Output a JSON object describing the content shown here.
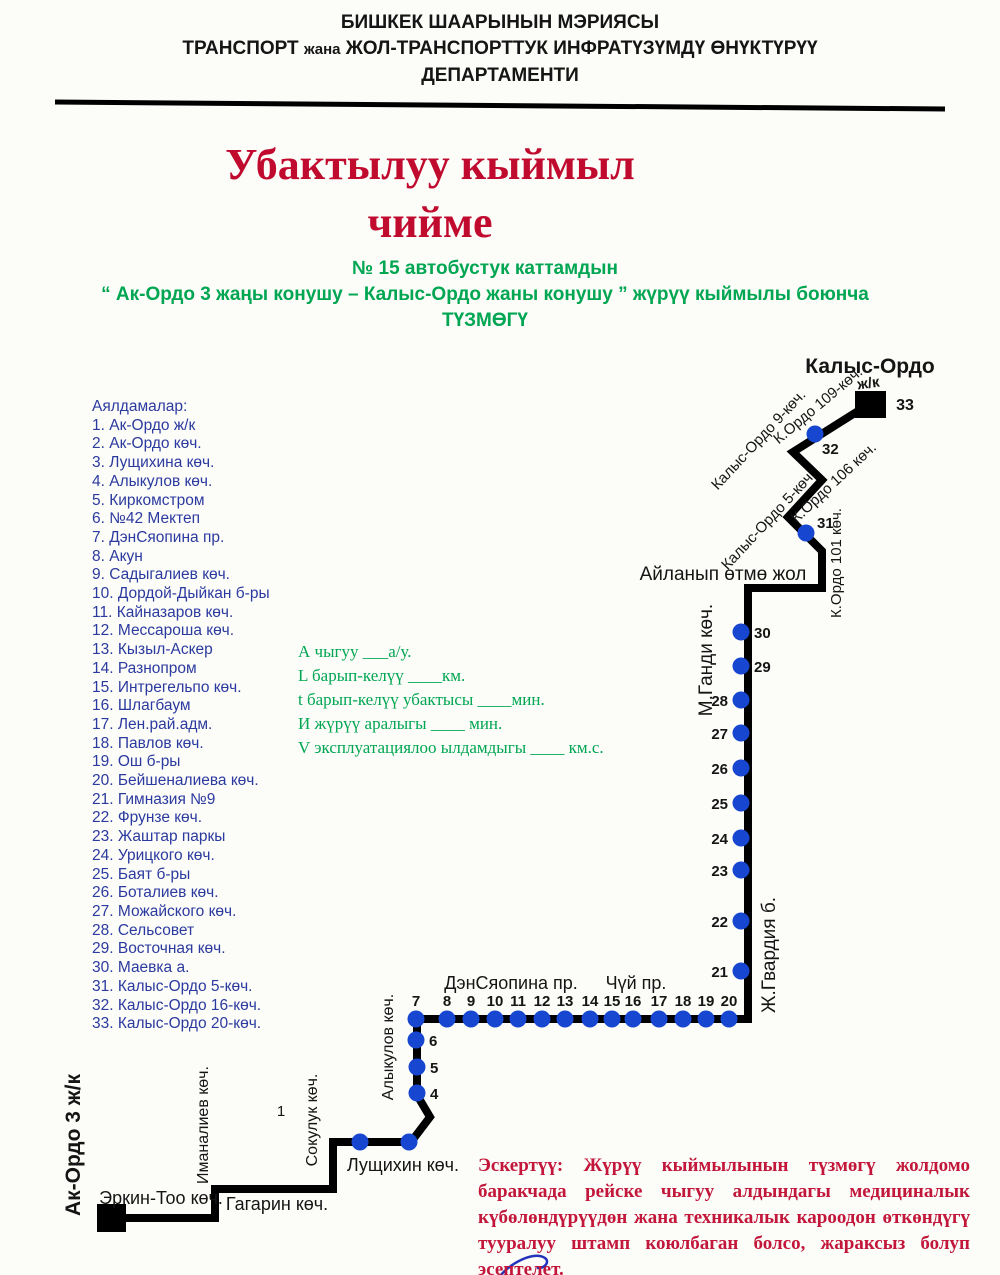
{
  "colors": {
    "title_red": "#c00b2f",
    "warning_red": "#c2173a",
    "green": "#00a651",
    "blue_text": "#2b3a9e",
    "dot_blue": "#1747d0",
    "route_black": "#000000"
  },
  "header": {
    "line1": "БИШКЕК ШААРЫНЫН МЭРИЯСЫ",
    "line2a": "ТРАНСПОРТ",
    "line2b": "жана",
    "line2c": "ЖОЛ-ТРАНСПОРТТУК ИНФРАТҮЗҮМДҮ ӨНҮКТҮРҮҮ",
    "line3": "ДЕПАРТАМЕНТИ"
  },
  "title": {
    "line1": "Убактылуу кыймыл",
    "line2": "чийме"
  },
  "subtitle": {
    "line1": "№ 15 автобустук каттамдын",
    "line2": "“ Ак-Ордо 3 жаңы конушу – Калыс-Ордо жаны конушу ” жүрүү кыймылы боюнча",
    "line3": "ТҮЗМӨГҮ"
  },
  "stops": {
    "heading": "Аялдамалар:",
    "items": [
      "1. Ак-Ордо ж/к",
      "2. Ак-Ордо көч.",
      "3. Лущихина көч.",
      "4. Алыкулов көч.",
      "5. Киркомстром",
      "6. №42 Мектеп",
      "7. ДэнСяопина пр.",
      "8. Акун",
      "9. Садыгалиев көч.",
      "10. Дордой-Дыйкан б-ры",
      "11. Кайназаров көч.",
      "12. Мессароша көч.",
      "13. Кызыл-Аскер",
      "14. Разнопром",
      "15. Интрегельпо көч.",
      "16. Шлагбаум",
      "17. Лен.рай.адм.",
      "18. Павлов көч.",
      "19. Ош б-ры",
      "20. Бейшеналиева көч.",
      "21. Гимназия №9",
      "22. Фрунзе көч.",
      "23. Жаштар паркы",
      "24. Урицкого көч.",
      "25. Баят б-ры",
      "26. Боталиев көч.",
      "27. Можайского көч.",
      "28. Сельсовет",
      "29. Восточная көч.",
      "30. Маевка а.",
      "31. Калыс-Ордо 5-көч.",
      "32. Калыс-Ордо 16-көч.",
      "33. Калыс-Ордо 20-көч."
    ]
  },
  "metrics": {
    "lines": [
      "А чыгуу   ___а/у.",
      "L барып-келүү    ____км.",
      "t барып-келүү убактысы    ____мин.",
      "И жүрүү аралыгы    ____ мин.",
      "V эксплуатациялоо ылдамдыгы ____ км.с."
    ]
  },
  "warning": {
    "bold": "Эскертүү:",
    "text": " Жүрүү кыймылынын түзмөгү жолдомо баракчада рейске чыгуу алдындагы медициналык күбөлөндүрүүдөн жана техникалык кароодон өткөндүгү тууралуу штамп коюлбаган болсо, жараксыз болуп эсептелет."
  },
  "diagram": {
    "rule": {
      "x1": 55,
      "y1": 102,
      "x2": 945,
      "y2": 109,
      "width": 5
    },
    "route_points": "125,1218 215,1218 215,1189 333,1189 333,1142 411,1142 430,1117 417,1095 417,1019 748,1019 748,588 822,588 822,551 788,517 822,480 793,452 866,406",
    "route_width": 8,
    "terminals": [
      {
        "name": "terminal-ak-ordo",
        "x": 97,
        "y": 1204,
        "w": 29,
        "h": 28
      },
      {
        "name": "terminal-kalys-ordo",
        "x": 855,
        "y": 391,
        "w": 31,
        "h": 27
      }
    ],
    "dots": [
      {
        "n": "2",
        "x": 360,
        "y": 1142,
        "side": "none"
      },
      {
        "n": "3",
        "x": 409,
        "y": 1142,
        "side": "none"
      },
      {
        "n": "4",
        "x": 417,
        "y": 1093,
        "side": "right"
      },
      {
        "n": "5",
        "x": 417,
        "y": 1067,
        "side": "right"
      },
      {
        "n": "6",
        "x": 416,
        "y": 1040,
        "side": "right"
      },
      {
        "n": "7",
        "x": 416,
        "y": 1019,
        "side": "top"
      },
      {
        "n": "8",
        "x": 447,
        "y": 1019,
        "side": "top"
      },
      {
        "n": "9",
        "x": 471,
        "y": 1019,
        "side": "top"
      },
      {
        "n": "10",
        "x": 495,
        "y": 1019,
        "side": "top"
      },
      {
        "n": "11",
        "x": 518,
        "y": 1019,
        "side": "top"
      },
      {
        "n": "12",
        "x": 542,
        "y": 1019,
        "side": "top"
      },
      {
        "n": "13",
        "x": 565,
        "y": 1019,
        "side": "top"
      },
      {
        "n": "14",
        "x": 590,
        "y": 1019,
        "side": "top"
      },
      {
        "n": "15",
        "x": 612,
        "y": 1019,
        "side": "top"
      },
      {
        "n": "16",
        "x": 633,
        "y": 1019,
        "side": "top"
      },
      {
        "n": "17",
        "x": 659,
        "y": 1019,
        "side": "top"
      },
      {
        "n": "18",
        "x": 683,
        "y": 1019,
        "side": "top"
      },
      {
        "n": "19",
        "x": 706,
        "y": 1019,
        "side": "top"
      },
      {
        "n": "20",
        "x": 729,
        "y": 1019,
        "side": "top"
      },
      {
        "n": "21",
        "x": 741,
        "y": 971,
        "side": "left"
      },
      {
        "n": "22",
        "x": 741,
        "y": 921,
        "side": "left"
      },
      {
        "n": "23",
        "x": 741,
        "y": 870,
        "side": "left"
      },
      {
        "n": "24",
        "x": 741,
        "y": 838,
        "side": "left"
      },
      {
        "n": "25",
        "x": 741,
        "y": 803,
        "side": "left"
      },
      {
        "n": "26",
        "x": 741,
        "y": 768,
        "side": "left"
      },
      {
        "n": "27",
        "x": 741,
        "y": 733,
        "side": "left"
      },
      {
        "n": "28",
        "x": 741,
        "y": 700,
        "side": "left"
      },
      {
        "n": "29",
        "x": 741,
        "y": 666,
        "side": "right"
      },
      {
        "n": "30",
        "x": 741,
        "y": 632,
        "side": "right"
      },
      {
        "n": "31",
        "x": 806,
        "y": 533,
        "side": "rightup"
      },
      {
        "n": "32",
        "x": 815,
        "y": 434,
        "side": "belowright"
      }
    ],
    "dot_radius": 8.5,
    "labels": [
      {
        "t": "Калыс-Ордо",
        "x": 870,
        "y": 373,
        "size": 21,
        "bold": true,
        "rot": 0
      },
      {
        "t": "ж/к",
        "x": 869,
        "y": 388,
        "size": 15,
        "bold": true,
        "rot": -8
      },
      {
        "t": "33",
        "x": 905,
        "y": 410,
        "size": 16,
        "bold": true,
        "rot": 0
      },
      {
        "t": "К.Ордо 109-көч.",
        "x": 821,
        "y": 409,
        "size": 15,
        "bold": false,
        "rot": -40
      },
      {
        "t": "Калыс-Ордо 9-көч.",
        "x": 762,
        "y": 443,
        "size": 15,
        "bold": false,
        "rot": -47
      },
      {
        "t": "К.Ордо 106 көч.",
        "x": 837,
        "y": 486,
        "size": 15,
        "bold": false,
        "rot": -43
      },
      {
        "t": "Калыс-Ордо 5-көч.",
        "x": 772,
        "y": 523,
        "size": 15,
        "bold": false,
        "rot": -47
      },
      {
        "t": "К.Ордо 101 көч.",
        "x": 841,
        "y": 563,
        "size": 15,
        "bold": false,
        "rot": -90
      },
      {
        "t": "Айланып өтмө жол",
        "x": 723,
        "y": 580,
        "size": 19,
        "bold": false,
        "rot": 0
      },
      {
        "t": "М.Ганди көч.",
        "x": 712,
        "y": 660,
        "size": 19,
        "bold": false,
        "rot": -90
      },
      {
        "t": "Ж.Гвардия б.",
        "x": 775,
        "y": 955,
        "size": 19,
        "bold": false,
        "rot": -90
      },
      {
        "t": "ДэнСяопина пр.",
        "x": 511,
        "y": 989,
        "size": 18,
        "bold": false,
        "rot": 0
      },
      {
        "t": "Чүй пр.",
        "x": 636,
        "y": 989,
        "size": 18,
        "bold": false,
        "rot": 0
      },
      {
        "t": "Алыкулов көч.",
        "x": 393,
        "y": 1047,
        "size": 16,
        "bold": false,
        "rot": -90
      },
      {
        "t": "1",
        "x": 281,
        "y": 1116,
        "size": 15,
        "bold": false,
        "rot": 0
      },
      {
        "t": "Лущихин көч.",
        "x": 403,
        "y": 1171,
        "size": 18,
        "bold": false,
        "rot": 0
      },
      {
        "t": "Сокулук көч.",
        "x": 317,
        "y": 1120,
        "size": 16,
        "bold": false,
        "rot": -90
      },
      {
        "t": "Иманалиев көч.",
        "x": 208,
        "y": 1125,
        "size": 16,
        "bold": false,
        "rot": -90
      },
      {
        "t": "Гагарин көч.",
        "x": 277,
        "y": 1210,
        "size": 18,
        "bold": false,
        "rot": 0
      },
      {
        "t": "Эркин-Тоо көч.",
        "x": 161,
        "y": 1204,
        "size": 18,
        "bold": false,
        "rot": 0
      },
      {
        "t": "Ак-Ордо 3 ж/к",
        "x": 80,
        "y": 1145,
        "size": 21,
        "bold": true,
        "rot": -90
      }
    ],
    "signature_path": "M500,1276 C512,1262 534,1251 545,1258 C550,1262 545,1268 538,1268"
  }
}
